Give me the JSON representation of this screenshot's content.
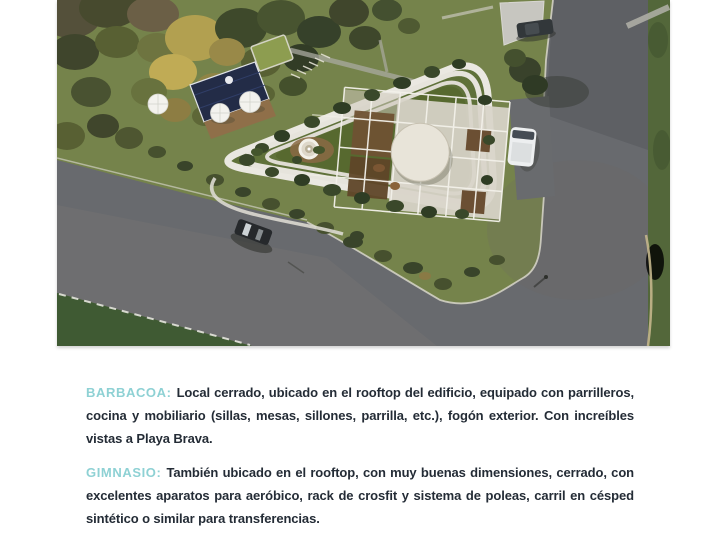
{
  "colors": {
    "accent": "#8ed1d4",
    "body_text": "#242c36",
    "page_background": "#ffffff"
  },
  "hero_image": {
    "description": "Aerial render of a triangular building with rooftop pergola, pool deck, streets, cars and autumn trees",
    "palette": {
      "lawn_green": "#75834b",
      "roof_garden_green": "#5f7139",
      "asphalt_gray": "#686a6e",
      "building_band_white": "#eae8e1",
      "rooftop_panel": "#d8d4c9",
      "pool_navy": "#232c47",
      "wood_deck": "#8f6f49",
      "concrete_pad": "#c7c6c0",
      "dark_lawn": "#3f5a33"
    }
  },
  "sections": [
    {
      "label": "BARBACOA:",
      "text": "Local cerrado, ubicado en el rooftop del edificio, equipado con parrilleros, cocina y mobiliario (sillas, mesas, sillones, parrilla, etc.), fogón exterior. Con increíbles vistas a Playa Brava."
    },
    {
      "label": "GIMNASIO:",
      "text": "También ubicado en el rooftop, con muy buenas dimensiones, cerrado, con excelentes aparatos para aeróbico, rack de crosfit y sistema de poleas, carril en césped sintético o similar para transferencias."
    }
  ]
}
